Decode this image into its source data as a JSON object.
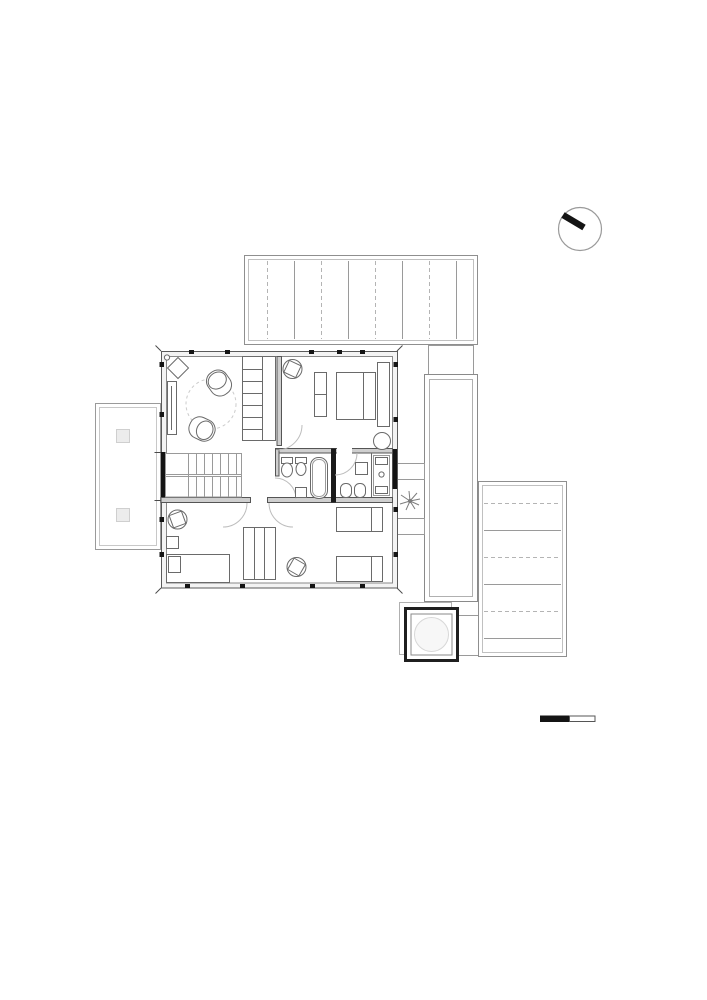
{
  "page": {
    "background": "#ffffff",
    "description": "Black-and-white architectural floor plan drawing (upper floor of a house) with a north indicator circle and a graphic scale bar. No text labels are visible in the drawing."
  },
  "colors": {
    "ink": "#141414",
    "wall_edge": "#555555",
    "wall_fill": "#cfcfcf",
    "wall_band_fill": "#f3f3f3",
    "thin_line": "#9a9a9a",
    "lighter_line": "#c0c0c0",
    "furniture_line": "#6a6a6a",
    "dashed_line": "#c4c4c4",
    "deck_line_solid": "#9a9a9a",
    "deck_line_dashed": "#b4b4b4",
    "column_fill": "#ececec",
    "skylight_fill": "#f7f7f7",
    "skylight_ring": "#d8d8d8"
  },
  "plan": {
    "house": {
      "shape": "square footprint, double-line exterior walls with black window mullion ticks",
      "rooms": [
        {
          "name": "living-area",
          "position": "top-left",
          "furniture": [
            "corner plant and diamond ornament",
            "wall desk",
            "two lounge chairs",
            "round rug (dashed circle)",
            "tall shelving unit"
          ]
        },
        {
          "name": "bedroom-1",
          "position": "top-right",
          "furniture": [
            "desk chair",
            "bench",
            "double bed",
            "headboard shelf",
            "round stool"
          ]
        },
        {
          "name": "staircase",
          "position": "middle-left",
          "detail": "two flights with central landing line"
        },
        {
          "name": "bathroom-1",
          "position": "middle-center",
          "furniture": [
            "wc",
            "washbasin",
            "bathtub",
            "low cabinet"
          ]
        },
        {
          "name": "bathroom-2",
          "position": "middle-right",
          "furniture": [
            "wall cabinet",
            "wc",
            "bidet",
            "shower cell with floor drain"
          ]
        },
        {
          "name": "bedroom-2",
          "position": "bottom-left",
          "furniture": [
            "desk chair",
            "nightstand",
            "single bed",
            "built-in wardrobe"
          ]
        },
        {
          "name": "bedroom-3",
          "position": "bottom-right",
          "furniture": [
            "desk chair",
            "two single beds"
          ]
        }
      ]
    },
    "exterior": [
      {
        "name": "balcony",
        "position": "left of house",
        "detail": "double-line rail with two square posts"
      },
      {
        "name": "roof-deck-top",
        "position": "above house",
        "detail": "plank pattern of alternating dashed and solid vertical lines"
      },
      {
        "name": "walkway",
        "position": "right of house",
        "detail": "tall double-line rectangle"
      },
      {
        "name": "roof-deck-right",
        "position": "lower right",
        "detail": "plank pattern of alternating dashed and solid horizontal lines"
      },
      {
        "name": "steps",
        "position": "between house and walkway",
        "count": 2
      },
      {
        "name": "planting-symbol",
        "position": "between steps",
        "detail": "star shaped plant glyph"
      },
      {
        "name": "skylight-or-spa",
        "position": "bottom of walkway",
        "detail": "thick-edged square with inner square and light circle, offset thin square behind"
      }
    ]
  },
  "annotations": {
    "north_indicator": {
      "shape": "thin circle with thick black needle pointing to upper-left rim"
    },
    "scale_bar": {
      "segments": [
        {
          "style": "filled-black"
        },
        {
          "style": "outlined-white"
        }
      ]
    }
  },
  "deck_patterns": [
    {
      "target": "deck-top-lines",
      "orient": "v",
      "count": 8,
      "start": 267,
      "step": 27,
      "from": 261,
      "to": 339
    },
    {
      "target": "deck-right-lines",
      "orient": "h",
      "count": 6,
      "start": 503,
      "step": 27,
      "from": 484,
      "to": 561
    }
  ]
}
